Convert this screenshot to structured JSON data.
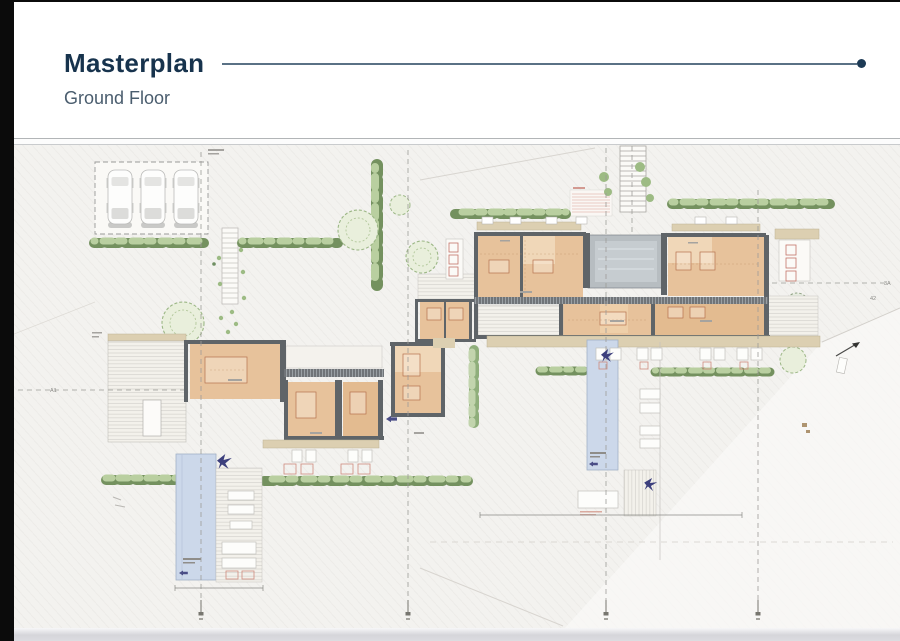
{
  "header": {
    "title": "Masterplan",
    "subtitle": "Ground Floor"
  },
  "plan": {
    "annotations": {
      "grid_left": "A1",
      "grid_right_top": "3A",
      "grid_right_bottom": "42"
    },
    "features": {
      "parking_spaces": 3,
      "pools": 2,
      "villas": 2,
      "bird_motifs": 3
    }
  },
  "colors": {
    "accent_navy": "#1c3a55",
    "header_rule": "#5a7185",
    "plan_bg": "#f3f2ef",
    "floor_orange": "#e7c29b",
    "wall_gray": "#5f6468",
    "deck_beige": "#dccfb1",
    "hedge_dark": "#74915f",
    "hedge_light": "#b9cfa0",
    "pool_blue": "#ccd8ea",
    "bird_indigo": "#3c3f7d"
  }
}
